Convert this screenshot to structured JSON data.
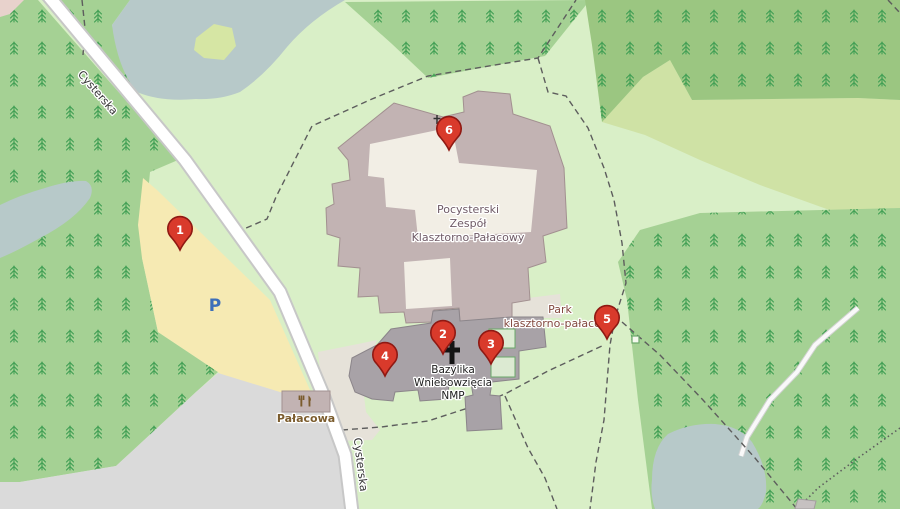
{
  "map": {
    "road_name": "Cysterska",
    "parking_symbol": "P",
    "labels": {
      "monastery": [
        "Pocysterski",
        "Zespół",
        "Klasztorno-Pałacowy"
      ],
      "church": [
        "Bazylika",
        "Wniebowzięcia",
        "NMP"
      ],
      "park": [
        "Park",
        "klasztorno-pałacowy"
      ],
      "restaurant": "Pałacowa"
    },
    "markers": [
      {
        "number": "1"
      },
      {
        "number": "2"
      },
      {
        "number": "3"
      },
      {
        "number": "4"
      },
      {
        "number": "5"
      },
      {
        "number": "6"
      }
    ],
    "icons": {
      "restaurant": "fork-and-knife",
      "church_cross": "latin-cross",
      "forest": "conifer-tree-symbol",
      "parking": "letter-P",
      "marker": "red-map-pin"
    },
    "colors": {
      "grass": "#d9efc7",
      "forest": "#a5d194",
      "forest_dark": "#9bc681",
      "scrub": "#cfe2a5",
      "water": "#b7c9c9",
      "island": "#d6e6a4",
      "parking_area": "#f6eab3",
      "gray_area": "#dadada",
      "pink_corner": "#e8d2cc",
      "building": "#c2b3b3",
      "building_stroke": "#a29090",
      "church": "#a8a2a7",
      "church_stroke": "#8b858a",
      "courtyard": "#f2eee5",
      "churchyard": "#e6e2d9",
      "cloister": "#dcead2",
      "cloister_stroke": "#6aa86a",
      "road_fill": "#ffffff",
      "road_casing": "#c7c7c7",
      "white_path": "#f9f9f9",
      "white_path_casing": "#d2d2d2",
      "path": "#5d5d5d",
      "marker": "#d93a2b",
      "marker_border": "#8f1913",
      "label_building": "#6f5a66",
      "label_park": "#83493f",
      "label_restaurant": "#7b5c2d",
      "label_road": "#333333",
      "parking_p": "#3d6fb9",
      "tree": "#3f9e53"
    }
  }
}
